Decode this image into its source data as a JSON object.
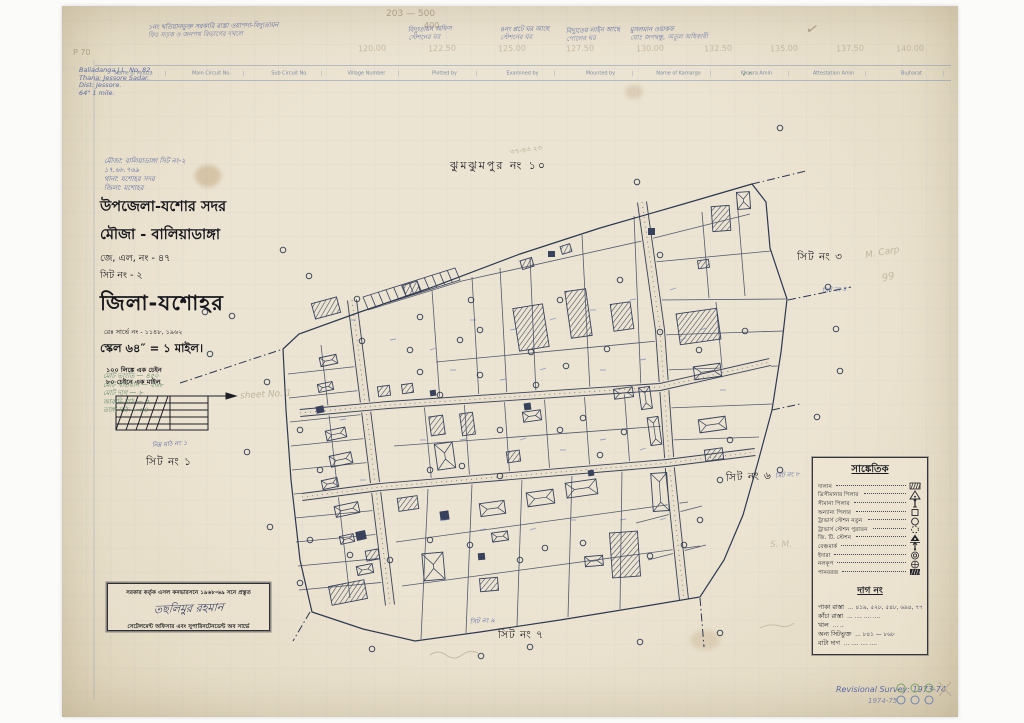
{
  "page": {
    "corner_mark": "P 70"
  },
  "form_header": {
    "columns": [
      "Name of Mouza",
      "Main Circuit No.",
      "Sub Circuit No.",
      "Village Number",
      "Plotted by",
      "Examined by",
      "Mounted by",
      "Name of Kamargo",
      "Khasra Amin",
      "Attestation Amin",
      "Bujharat"
    ]
  },
  "corner_notes": [
    "Baliadanga  J.L. No. 82.",
    "Thana: Jessore Sadar.",
    "Dist: Jessore.",
    "64\" 1 mile."
  ],
  "top": {
    "pencil_numbers": "203 — 500",
    "pencil_numbers2": "400",
    "checkmark": "✓",
    "groups": [
      {
        "l1": "১নং খতিয়ানভুক্ত সরকারি রাস্তা ওয়াপদা-বিদ্যুতায়ন",
        "l2": "ফিঃ সড়ক ও জনপথ বিভাগের দখলে"
      },
      {
        "l1": "বিদ্যুতায়ন অফিস",
        "l2": "স্টেশনের ঘর"
      },
      {
        "l1": "৪নং প্লটে ঘর আছে",
        "l2": "স্টেশনের ঘর"
      },
      {
        "l1": "বিদ্যুতের লাইন আছে",
        "l2": "পোলের ঘর"
      },
      {
        "l1": "মুসলমান ওয়াকফ",
        "l2": "ঘোঃ জগদ্বন্ধু, অতুল অধিকারী"
      }
    ],
    "coordinates": [
      "120.00",
      "122.50",
      "125.00",
      "127.50",
      "130.00",
      "132.50",
      "135.00",
      "137.50",
      "140.00"
    ]
  },
  "title_block": {
    "handwritten_lines": [
      "মৌজা: বালিয়াডাঙ্গা সিট নং-২",
      "১৭.৬৮.৭৬৯",
      "থানা: যশোহর সদর",
      "জিলা: যশোহর"
    ],
    "upazila": "উপজেলা-যশোর সদর",
    "mouza": "মৌজা - বালিয়াডাঙ্গা",
    "jl_no": "জে, এল, নং - ৪৭",
    "sheet_no": "সিট নং - ২",
    "district": "জিলা-যশোহর",
    "survey_no": "রেঃ সার্ভে নং - ১১৪৮, ১৯৬২",
    "scale": "স্কেল ৬৪″ = ১ মাইল।",
    "scale_note1": "১০০ লিঙ্কে এক চেইন",
    "scale_note2": "৮০ চেইনে এক মাইল"
  },
  "side_notes": {
    "green": [
      "মোট ভাংতি — ৪৫০",
      "মোট খতিয়ান — ২৬৮",
      "মোট দাগ — ৮",
      "আবাদি মাঠ — ৫",
      "ডাঙ্গা মাঠ — ৬৪"
    ],
    "pencil": "sheet No. 1"
  },
  "labels": {
    "adjacent": "ঝুমঝুমপুর নং ১০",
    "pencil_adjacent": "৩৭-৪৩ ২৩",
    "sheet1": "সিট নং ১",
    "sheet1_hw": "নিম্ন মাঠ নং ১",
    "sheet3": "সিট নং ৩",
    "sheet4_hw": "সিট নং ৪",
    "pencil_carp": "M. Carp",
    "pencil_carp2": "99",
    "sheet6": "সিট নং ৬",
    "sheet8_hw": "সিট নং ৮",
    "pencil_sm": "S. M.",
    "sheet7": "সিট নং ৭",
    "sheet9_hw": "সিট নং ৯"
  },
  "legend": {
    "title": "সাঙ্কেতিক",
    "items": [
      {
        "label": "দালান",
        "symbol": "hatched-rect"
      },
      {
        "label": "ত্রিসীমানার পিলার",
        "symbol": "triangle-dot"
      },
      {
        "label": "সীমানা পিলার",
        "symbol": "post"
      },
      {
        "label": "অন্যান্য পিলার",
        "symbol": "square"
      },
      {
        "label": "ট্রাভার্স স্টেশন নতুন",
        "symbol": "circle"
      },
      {
        "label": "ট্রাভার্স স্টেশন পুরাতন",
        "symbol": "circle-dashed"
      },
      {
        "label": "জি. টি. স্টেশন",
        "symbol": "gt-triangle"
      },
      {
        "label": "বেঞ্চমার্ক",
        "symbol": "benchmark"
      },
      {
        "label": "ইদারা",
        "symbol": "double-circle"
      },
      {
        "label": "নলকূপ",
        "symbol": "circle-cross"
      },
      {
        "label": "পানবরজ",
        "symbol": "hatched-solid"
      }
    ],
    "dag_title": "দাগ নং",
    "dag_items": [
      {
        "label": "পাকা রাস্তা",
        "value": "৪১৯, ৫২৮, ৫৪৮, ৬৯৪, ৭৭৩"
      },
      {
        "label": "কাঁচা রাস্তা",
        "value": "....      ....      ...."
      },
      {
        "label": "খাল",
        "value": ".."
      },
      {
        "label": "অন্য সিটভুক্ত",
        "value": "৮৪১ — ৮৬৮"
      },
      {
        "label": "বাটা দাগ",
        "value": "....      ....      ...."
      }
    ]
  },
  "stamp": {
    "line1": "সরকার কর্তৃক এসল কনভারসনে ১৯৬৮-৬৯ সনে প্রস্তুত",
    "signature": "তছলিমুর রহমান",
    "line3": "সেটেলমেন্ট অফিসার এবং সুপারিনটেনডেন্ট অব সার্ভে"
  },
  "revision": {
    "line1": "Revisional Survey: 1973-74.",
    "line2": "1974-75."
  }
}
